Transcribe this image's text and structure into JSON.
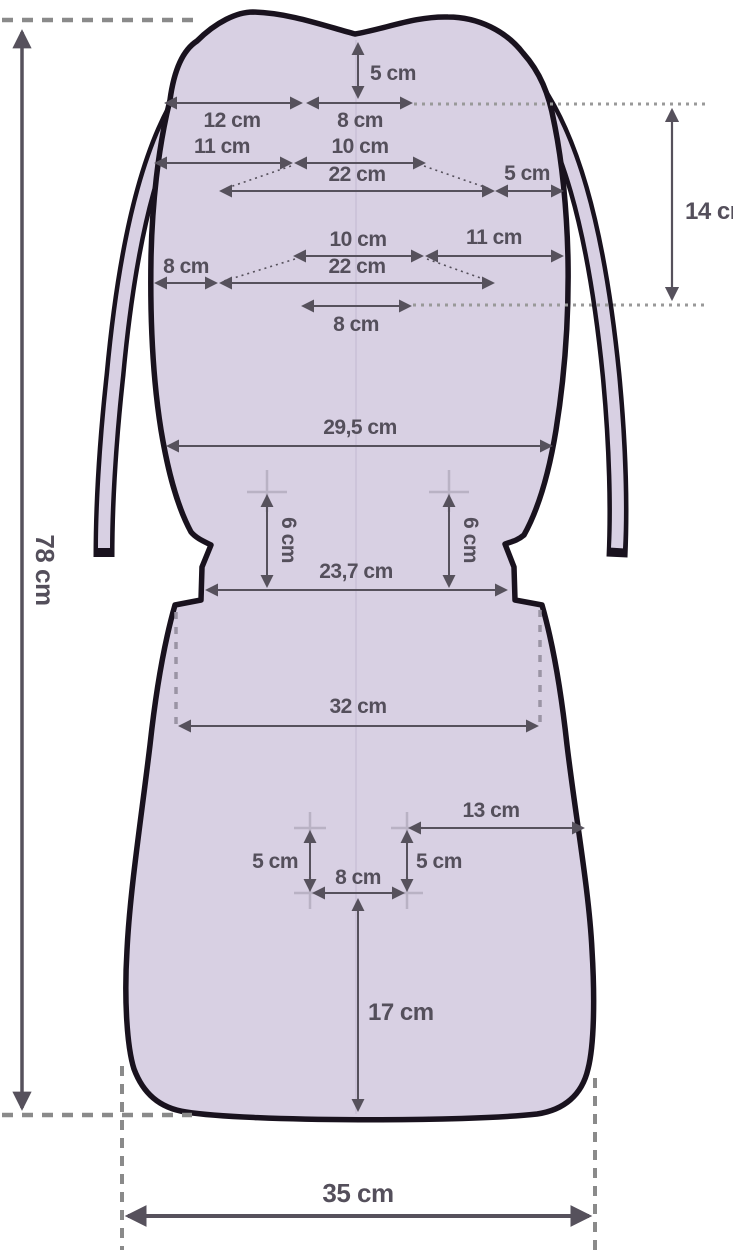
{
  "pattern": {
    "unit": "cm",
    "fill_color": "#d8d0e3",
    "outline_color": "#19121e",
    "dimension_color": "#56515c",
    "guide_color": "#8a8a8a",
    "cross_color": "#b9b2c4"
  },
  "dims": {
    "total_height": "78 cm",
    "top_notch_depth": "5 cm",
    "top_left_segment": "12 cm",
    "top_center_segment": "8 cm",
    "upper_row_left": "11 cm",
    "upper_row_center": "10 cm",
    "upper_slot_width": "22 cm",
    "upper_row_right": "5 cm",
    "slot_vertical_gap": "14 cm",
    "lower_row_center": "10 cm",
    "lower_row_right": "11 cm",
    "lower_row_left": "8 cm",
    "lower_slot_width": "22 cm",
    "lower_center_offset": "8 cm",
    "backrest_width": "29,5 cm",
    "waist_left_height": "6 cm",
    "waist_right_height": "6 cm",
    "waist_width": "23,7 cm",
    "seat_top_width": "32 cm",
    "seat_right_offset": "13 cm",
    "slot_left_height": "5 cm",
    "slot_right_height": "5 cm",
    "slot_width": "8 cm",
    "seat_bottom_height": "17 cm",
    "bottom_width": "35 cm"
  }
}
